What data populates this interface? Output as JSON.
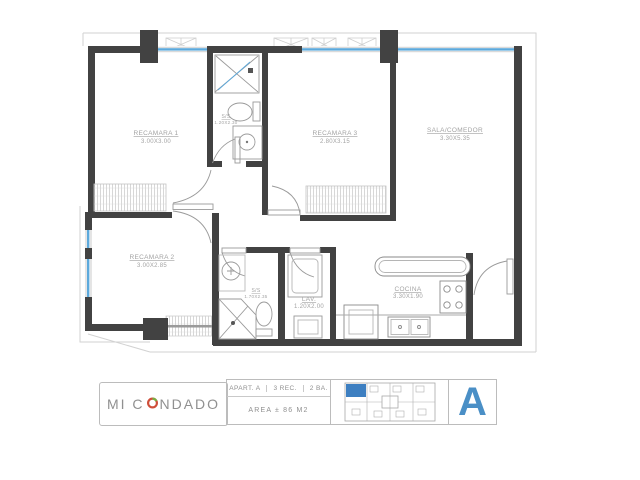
{
  "plan": {
    "rooms": {
      "rec1": {
        "name": "RECAMARA 1",
        "dims": "3.00X3.00"
      },
      "rec3": {
        "name": "RECAMARA 3",
        "dims": "2.80X3.15"
      },
      "sala": {
        "name": "SALA/COMEDOR",
        "dims": "3.30X5.35"
      },
      "rec2": {
        "name": "RECAMARA 2",
        "dims": "3.00X2.85"
      },
      "bath1": {
        "name": "S/S",
        "dims": "1.20X2.30"
      },
      "bath2": {
        "name": "S/S",
        "dims": "1.70X2.35"
      },
      "lav": {
        "name": "LAV.",
        "dims": "1.20X2.00"
      },
      "cocina": {
        "name": "COCINA",
        "dims": "3.30X1.90"
      }
    }
  },
  "titleblock": {
    "brand_prefix": "MI C",
    "brand_suffix": "NDADO",
    "specs": {
      "apartment": "APART. A",
      "bedrooms": "3 REC.",
      "bathrooms": "2 BA.",
      "area": "AREA ± 86 M2"
    },
    "unit_letter": "A"
  },
  "colors": {
    "wall": "#424242",
    "window_glass": "#5ca9dc",
    "unit_letter_blue": "#4a8fc6",
    "keyplan_highlight": "#3d7fc1",
    "logo_red": "#cf4f3a",
    "logo_green": "#76b043"
  }
}
